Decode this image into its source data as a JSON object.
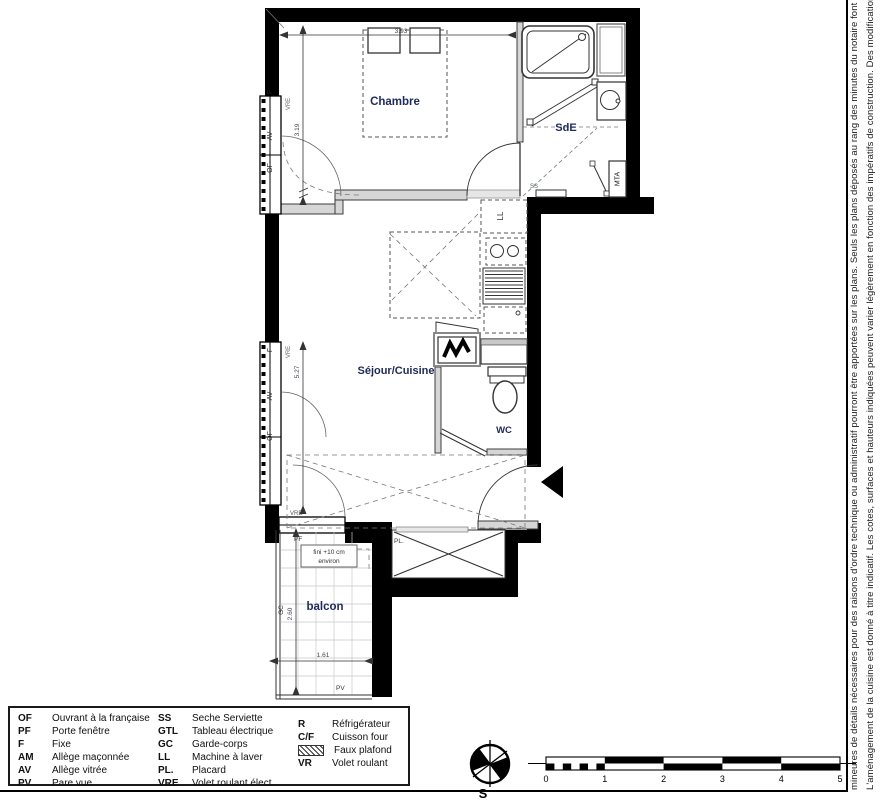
{
  "plan": {
    "rooms": {
      "chambre": "Chambre",
      "sde": "SdE",
      "sejour": "Séjour/Cuisine",
      "wc": "WC",
      "balcon": "balcon"
    },
    "win": {
      "f": "F",
      "av": "AV",
      "of": "OF",
      "vre": "VRE"
    },
    "labels": {
      "pf": "PF",
      "pl": "PL.",
      "ll": "LL",
      "ss": "SS",
      "mta": "MTA",
      "gc": "GC",
      "pv": "PV"
    },
    "dims": {
      "chambre_width": "3.93",
      "chambre_depth": "3.19",
      "sejour_depth": "5.27",
      "balcon_depth": "2.60",
      "balcon_width": "1.61"
    },
    "note": {
      "line1": "fini +10 cm",
      "line2": "environ"
    }
  },
  "compass": {
    "south": "S"
  },
  "scalebar": {
    "ticks": [
      "0",
      "1",
      "2",
      "3",
      "4",
      "5"
    ]
  },
  "legend": {
    "col1": [
      {
        "abbr": "OF",
        "label": "Ouvrant à la française"
      },
      {
        "abbr": "PF",
        "label": "Porte fenêtre"
      },
      {
        "abbr": "F",
        "label": "Fixe"
      },
      {
        "abbr": "AM",
        "label": "Allège maçonnée"
      },
      {
        "abbr": "AV",
        "label": "Allège vitrée"
      },
      {
        "abbr": "PV",
        "label": "Pare vue"
      }
    ],
    "col2": [
      {
        "abbr": "SS",
        "label": "Seche Serviette"
      },
      {
        "abbr": "GTL",
        "label": "Tableau électrique"
      },
      {
        "abbr": "GC",
        "label": "Garde-corps"
      },
      {
        "abbr": "LL",
        "label": "Machine à laver"
      },
      {
        "abbr": "PL.",
        "label": "Placard"
      },
      {
        "abbr": "VRE",
        "label": "Volet roulant élect."
      }
    ],
    "col3": [
      {
        "abbr": "R",
        "label": "Réfrigérateur"
      },
      {
        "abbr": "C/F",
        "label": "Cuisson four"
      },
      {
        "abbr": "",
        "label": "Faux plafond"
      },
      {
        "abbr": "VR",
        "label": "Volet roulant"
      }
    ]
  },
  "disclaimer": {
    "line1": "L'aménagement de la cuisine est donné à titre indicatif. Les cotes, surfaces et hauteurs indiquées peuvent varier légèrement en fonction des impératifs de construction. Des modifications",
    "line2": "mineures de détails nécessaires pour des raisons d'ordre technique ou administratif pourront être apportées sur les plans. Seuls les plans déposés au rang des minutes du notaire font foi."
  }
}
